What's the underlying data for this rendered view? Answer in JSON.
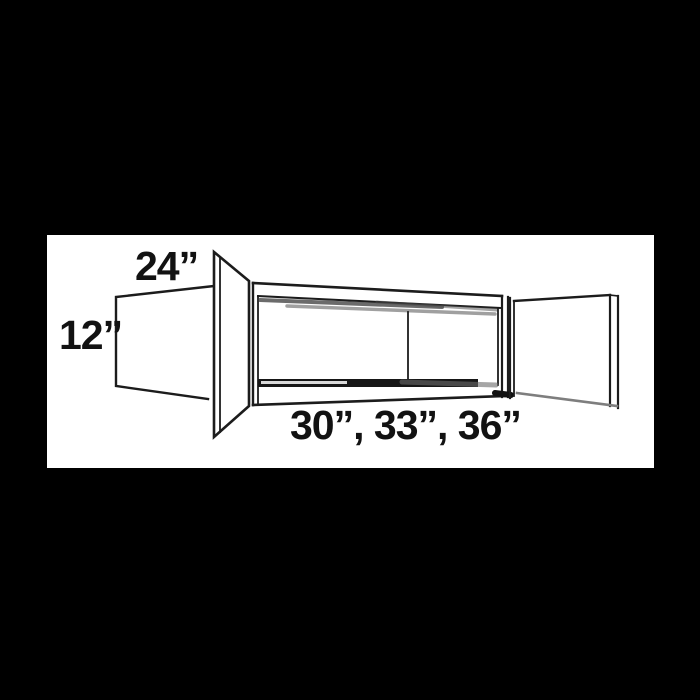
{
  "canvas": {
    "background_color": "#000000",
    "panel_color": "#ffffff",
    "line_color": "#1c1c1c",
    "shading_color": "#555555",
    "text_color": "#121212"
  },
  "diagram": {
    "subject": "wall-cabinet-line-drawing-two-open-doors",
    "labels": {
      "depth": "24”",
      "height": "12”",
      "widths": "30”, 33”, 36”"
    }
  }
}
